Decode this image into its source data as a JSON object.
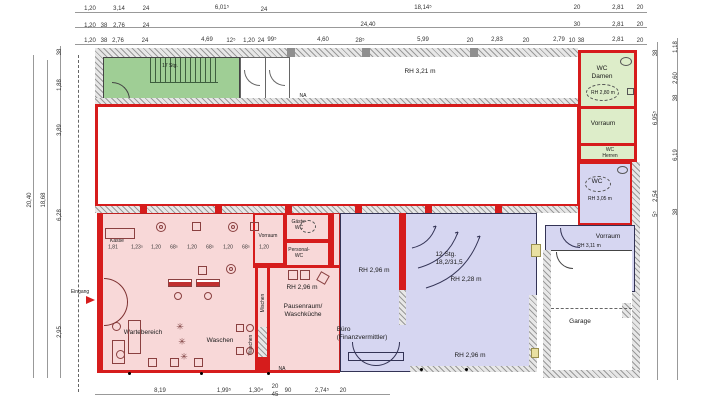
{
  "colors": {
    "wall_red": "#d61c1c",
    "salon_pink": "#f8d8d8",
    "office_purple": "#d6d6f1",
    "green_room": "#9fce95",
    "wc_green": "#ddedc9",
    "accent_yellow": "#e9e0a2",
    "hatch_gray": "#9a9a9a"
  },
  "rooms": {
    "stair_tl": "17 Stg.",
    "hall_rh": "RH 3,21 m",
    "na": "NA",
    "wc_damen": "WC\nDamen",
    "wc_damen_rh": "RH 2,80 m",
    "vorraum_top": "Vorraum",
    "wc_herren": "WC\nHerren",
    "wc_right": "WC",
    "wc_right_rh": "RH 3,05 m",
    "vorraum_right": "Vorraum",
    "vorraum_right_rh": "RH 3,11 m",
    "garage": "Garage",
    "kasse": "Kasse",
    "wartebereich": "Wartebereich",
    "waschen": "Waschen",
    "mischen": "Mischen",
    "vorraum_mid": "Vorraum",
    "gaeste_wc": "Gäste-\nWC",
    "personal_wc": "Personal-\nWC",
    "rh_296": "RH 2,96 m",
    "pausenraum": "Pausenraum/\nWaschküche",
    "stairs_12": "12 Stg.\n18,2/31,5",
    "rh_228": "RH 2,28 m",
    "buero": "Büro\n(Finanzvermittler)",
    "eingang": "Eingang"
  },
  "icons": {
    "plant": "✳"
  },
  "dims": {
    "labels": [
      {
        "t": "1,20",
        "x": 90,
        "y": 9
      },
      {
        "t": "3,14",
        "x": 119,
        "y": 9
      },
      {
        "t": "24",
        "x": 146,
        "y": 9
      },
      {
        "t": "6,01⁵",
        "x": 222,
        "y": 8
      },
      {
        "t": "24",
        "x": 264,
        "y": 10
      },
      {
        "t": "18,14⁵",
        "x": 423,
        "y": 8
      },
      {
        "t": "20",
        "x": 577,
        "y": 8
      },
      {
        "t": "2,81",
        "x": 618,
        "y": 8
      },
      {
        "t": "20",
        "x": 640,
        "y": 8
      },
      {
        "t": "1,20",
        "x": 90,
        "y": 26
      },
      {
        "t": "38",
        "x": 104,
        "y": 26
      },
      {
        "t": "2,76",
        "x": 119,
        "y": 26
      },
      {
        "t": "24",
        "x": 146,
        "y": 26
      },
      {
        "t": "24,40",
        "x": 368,
        "y": 25
      },
      {
        "t": "30",
        "x": 577,
        "y": 25
      },
      {
        "t": "2,81",
        "x": 618,
        "y": 25
      },
      {
        "t": "20",
        "x": 640,
        "y": 25
      },
      {
        "t": "1,20",
        "x": 90,
        "y": 41
      },
      {
        "t": "38",
        "x": 104,
        "y": 41
      },
      {
        "t": "2,76",
        "x": 118,
        "y": 41
      },
      {
        "t": "24",
        "x": 145,
        "y": 41
      },
      {
        "t": "4,69",
        "x": 207,
        "y": 40
      },
      {
        "t": "12⁵",
        "x": 231,
        "y": 41
      },
      {
        "t": "1,20",
        "x": 249,
        "y": 41
      },
      {
        "t": "24",
        "x": 261,
        "y": 41
      },
      {
        "t": "99⁵",
        "x": 272,
        "y": 40
      },
      {
        "t": "4,60",
        "x": 323,
        "y": 40
      },
      {
        "t": "28⁵",
        "x": 360,
        "y": 41
      },
      {
        "t": "5,99",
        "x": 423,
        "y": 40
      },
      {
        "t": "20",
        "x": 470,
        "y": 41
      },
      {
        "t": "2,83",
        "x": 497,
        "y": 40
      },
      {
        "t": "20",
        "x": 526,
        "y": 41
      },
      {
        "t": "2,79",
        "x": 559,
        "y": 40
      },
      {
        "t": "10",
        "x": 572,
        "y": 41
      },
      {
        "t": "38",
        "x": 581,
        "y": 41
      },
      {
        "t": "2,81",
        "x": 618,
        "y": 40
      },
      {
        "t": "20",
        "x": 640,
        "y": 41
      },
      {
        "t": "20,40",
        "x": 30,
        "y": 200,
        "r": 1
      },
      {
        "t": "18,68",
        "x": 44,
        "y": 200,
        "r": 1
      },
      {
        "t": "38",
        "x": 60,
        "y": 52,
        "r": 1
      },
      {
        "t": "1,88",
        "x": 60,
        "y": 85,
        "r": 1
      },
      {
        "t": "3,89",
        "x": 60,
        "y": 130,
        "r": 1
      },
      {
        "t": "6,28",
        "x": 60,
        "y": 215,
        "r": 1
      },
      {
        "t": "2,95",
        "x": 60,
        "y": 332,
        "r": 1
      },
      {
        "t": "1,18",
        "x": 676,
        "y": 47,
        "r": 1
      },
      {
        "t": "2,60",
        "x": 676,
        "y": 78,
        "r": 1
      },
      {
        "t": "38",
        "x": 676,
        "y": 98,
        "r": 1
      },
      {
        "t": "6,19",
        "x": 676,
        "y": 155,
        "r": 1
      },
      {
        "t": "38",
        "x": 676,
        "y": 212,
        "r": 1
      },
      {
        "t": "38",
        "x": 656,
        "y": 53,
        "r": 1
      },
      {
        "t": "6,95⁵",
        "x": 656,
        "y": 118,
        "r": 1
      },
      {
        "t": "2,54",
        "x": 656,
        "y": 196,
        "r": 1
      },
      {
        "t": "5⁵",
        "x": 656,
        "y": 214,
        "r": 1
      },
      {
        "t": "8,19",
        "x": 160,
        "y": 391
      },
      {
        "t": "1,99⁵",
        "x": 224,
        "y": 391
      },
      {
        "t": "1,30⁴",
        "x": 256,
        "y": 391
      },
      {
        "t": "20",
        "x": 275,
        "y": 387
      },
      {
        "t": "45",
        "x": 275,
        "y": 395
      },
      {
        "t": "90",
        "x": 288,
        "y": 391
      },
      {
        "t": "2,74⁵",
        "x": 322,
        "y": 391
      },
      {
        "t": "20",
        "x": 343,
        "y": 391
      },
      {
        "t": "1,81",
        "x": 113,
        "y": 248,
        "s": 1
      },
      {
        "t": "1,23⁵",
        "x": 137,
        "y": 248,
        "s": 1
      },
      {
        "t": "1,20",
        "x": 156,
        "y": 248,
        "s": 1
      },
      {
        "t": "68⁵",
        "x": 174,
        "y": 248,
        "s": 1
      },
      {
        "t": "1,20",
        "x": 192,
        "y": 248,
        "s": 1
      },
      {
        "t": "68⁵",
        "x": 210,
        "y": 248,
        "s": 1
      },
      {
        "t": "1,20",
        "x": 228,
        "y": 248,
        "s": 1
      },
      {
        "t": "68⁵",
        "x": 246,
        "y": 248,
        "s": 1
      },
      {
        "t": "1,20",
        "x": 264,
        "y": 248,
        "s": 1
      }
    ]
  }
}
